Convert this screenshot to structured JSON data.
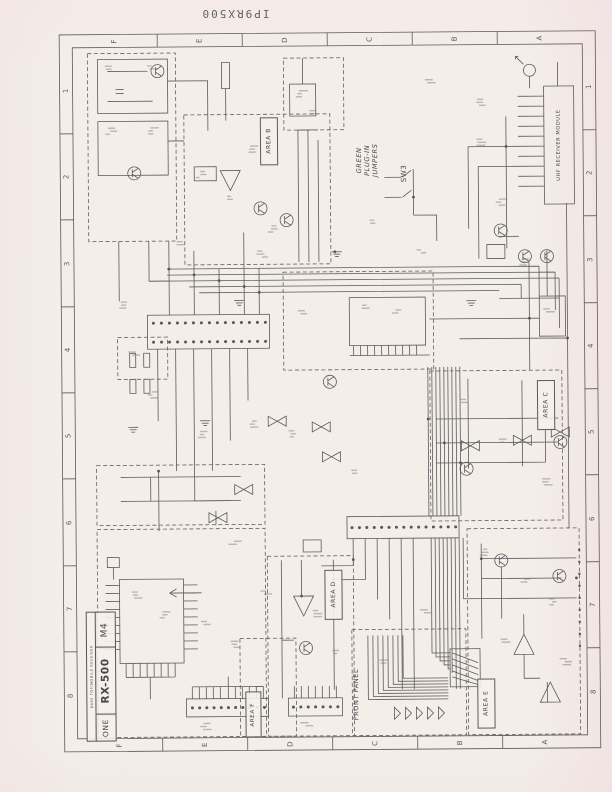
{
  "page": {
    "header_code": "IP9RX500",
    "ink_color": "#5a5a5a",
    "paper_color": "#f4eee9"
  },
  "border": {
    "column_letters": [
      "F",
      "E",
      "D",
      "C",
      "B",
      "A"
    ],
    "row_numbers": [
      "1",
      "2",
      "3",
      "4",
      "5",
      "6",
      "7",
      "8"
    ]
  },
  "title_block": {
    "rev": "M4",
    "model": "RX-500",
    "sheet": "ONE",
    "note": "BASE TOP/MOBILE RECEIVER"
  },
  "areas": [
    {
      "id": "area-b",
      "label": "AREA B"
    },
    {
      "id": "area-c",
      "label": "AREA C"
    },
    {
      "id": "area-d",
      "label": "AREA D"
    },
    {
      "id": "area-e",
      "label": "AREA E"
    },
    {
      "id": "area-f",
      "label": "AREA F"
    }
  ],
  "labels": {
    "front_panel": "FRONT PANEL",
    "module": "UHF RECEIVER MODULE",
    "switch": "SW3",
    "jumpers_note": "GREEN\nPLUG-IN\nJUMPERS"
  }
}
